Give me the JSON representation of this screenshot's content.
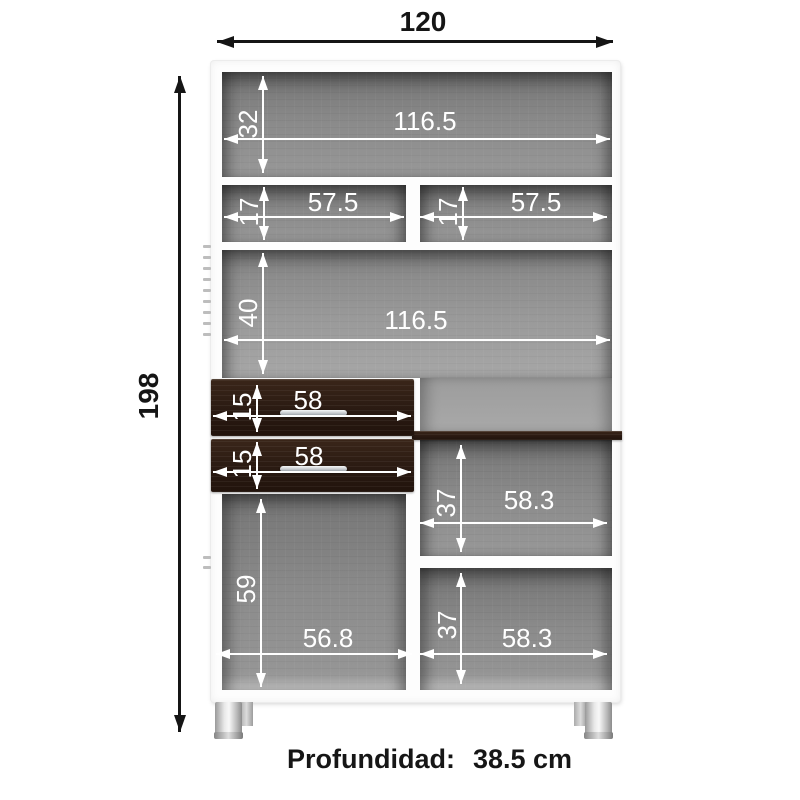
{
  "footer": {
    "label": "Profundidad:",
    "value": "38.5 cm"
  },
  "dimensions": {
    "total_width": "120",
    "total_height": "198",
    "top_section_height": "32",
    "top_section_width": "116.5",
    "row2_left_height": "17",
    "row2_left_width": "57.5",
    "row2_right_height": "17",
    "row2_right_width": "57.5",
    "mid_section_height": "40",
    "mid_section_width": "116.5",
    "drawer1_height": "15",
    "drawer1_width": "58",
    "drawer2_height": "15",
    "drawer2_width": "58",
    "right_upper_height": "37",
    "right_upper_width": "58.3",
    "left_lower_height": "59",
    "left_lower_width": "56.8",
    "right_lower_height": "37",
    "right_lower_width": "58.3"
  },
  "colors": {
    "background": "#ffffff",
    "dimension_line_inner": "#ffffff",
    "dimension_line_outer": "#151515",
    "cabinet_frame": "#fdfdfd",
    "interior_gray": "#8b8b8b",
    "wood_dark": "#2a1a12",
    "handle_silver": "#c3c7cc",
    "leg_silver": "#d5d5d5"
  }
}
